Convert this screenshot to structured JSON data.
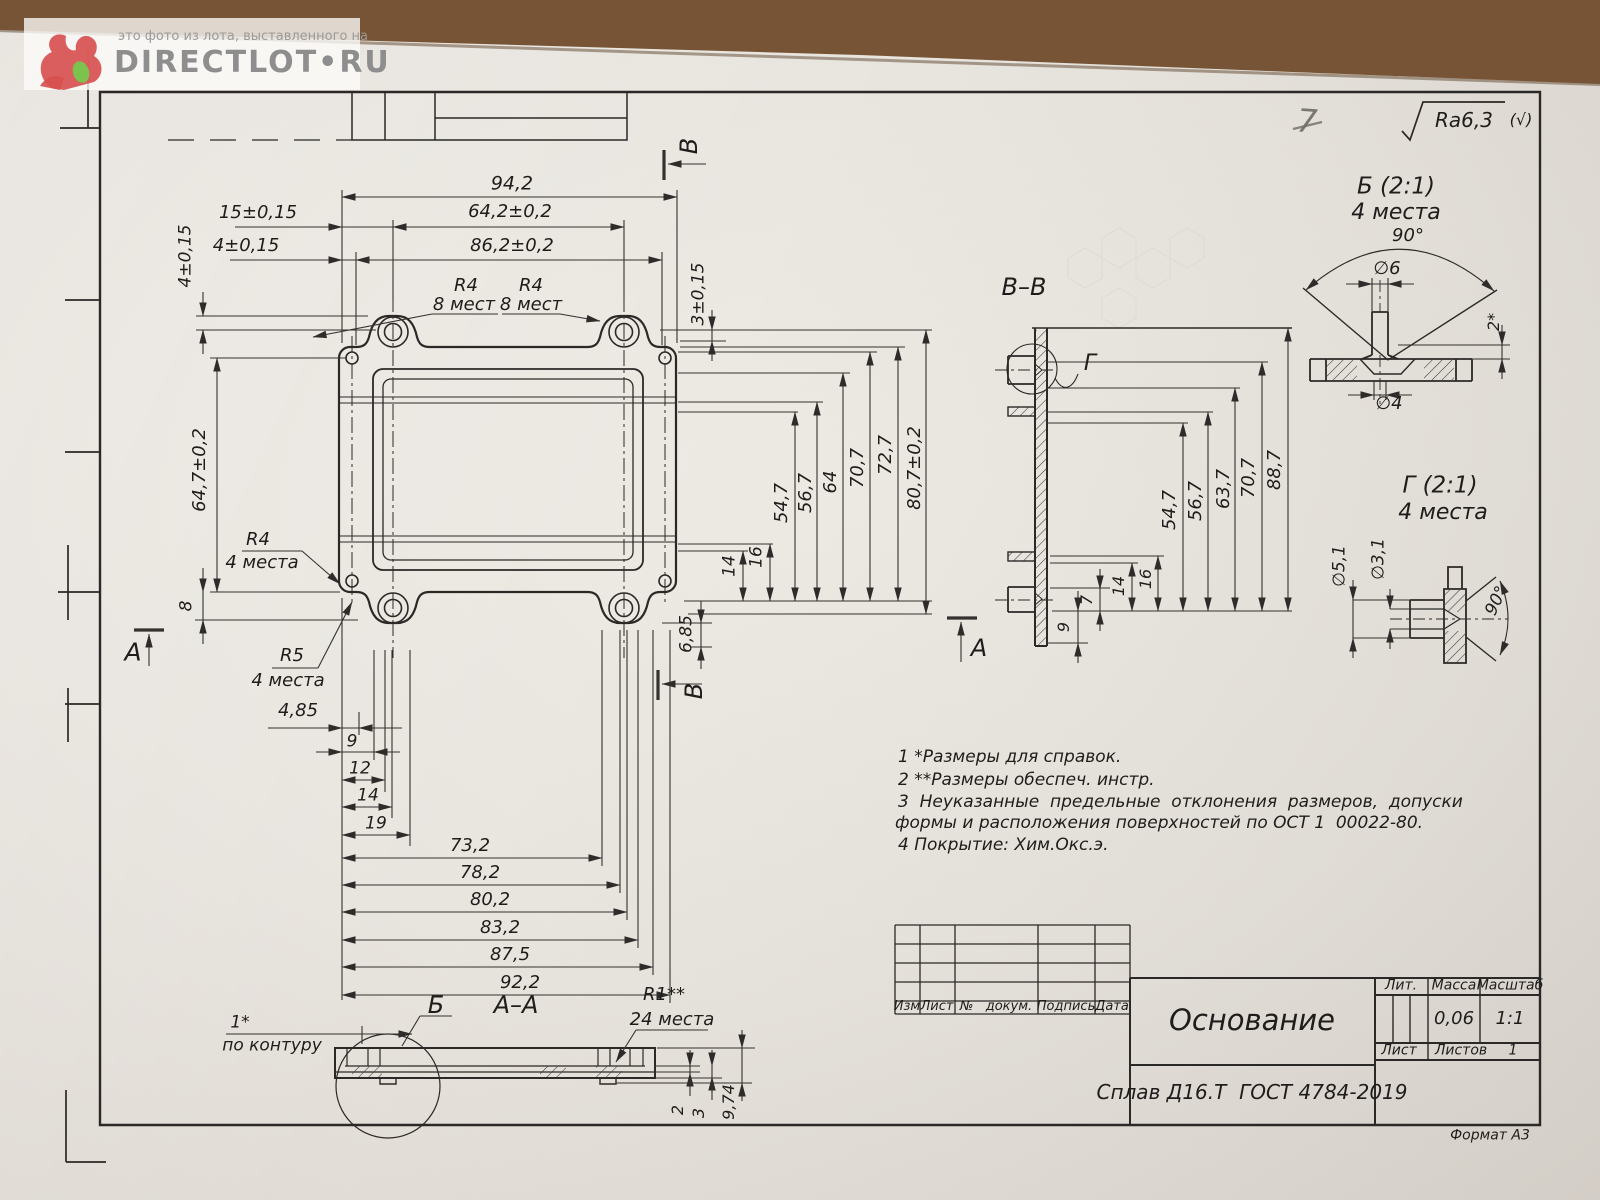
{
  "watermark": {
    "caption": "это фото из лота, выставленного на",
    "brand": "DIRECTLOT•RU"
  },
  "sheet": {
    "pencil_mark": "7",
    "surface_finish": "Ra6,3",
    "surface_finish_suffix": "(√)",
    "format_label": "Формат А3"
  },
  "colors": {
    "paper": "#e9e6e0",
    "line": "#2e2c2a",
    "wood": "#775435",
    "watermark_gray": "#8e8e8e",
    "logo_red": "#d85050",
    "logo_green": "#7cc24e",
    "pencil": "#6f6b66"
  },
  "notes": {
    "lines": [
      "1 *Размеры для справок.",
      "2 **Размеры обеспеч. инстр.",
      "3  Неуказанные  предельные  отклонения  размеров,  допуски",
      "формы и расположения поверхностей по ОСТ 1  00022-80.",
      "4 Покрытие: Хим.Окс.э."
    ]
  },
  "revision_table": {
    "headers": [
      "Изм",
      "Лист",
      "№   докум.",
      "Подпись",
      "Дата"
    ]
  },
  "title_block": {
    "part_name": "Основание",
    "lit_label": "Лит.",
    "mass_label": "Масса",
    "scale_label": "Масштаб",
    "mass_value": "0,06",
    "scale_value": "1:1",
    "sheet_label": "Лист",
    "sheets_label": "Листов",
    "sheets_value": "1",
    "material": "Сплав Д16.Т  ГОСТ 4784-2019"
  },
  "labels": [
    {
      "n": "dim-94-2",
      "t": "94,2",
      "x": 512,
      "y": 184,
      "s": 19
    },
    {
      "n": "dim-15",
      "t": "15±0,15",
      "x": 258,
      "y": 213,
      "s": 18
    },
    {
      "n": "dim-64-2",
      "t": "64,2±0,2",
      "x": 510,
      "y": 212,
      "s": 18
    },
    {
      "n": "dim-4-top",
      "t": "4±0,15",
      "x": 246,
      "y": 246,
      "s": 18
    },
    {
      "n": "dim-86-2",
      "t": "86,2±0,2",
      "x": 512,
      "y": 246,
      "s": 18
    },
    {
      "n": "radius-r4-top-1",
      "t": "R4",
      "x": 466,
      "y": 286,
      "s": 18
    },
    {
      "n": "radius-r4-top-1-qty",
      "t": "8 мест",
      "x": 464,
      "y": 305,
      "s": 18
    },
    {
      "n": "radius-r4-top-2",
      "t": "R4",
      "x": 531,
      "y": 286,
      "s": 18
    },
    {
      "n": "radius-r4-top-2-qty",
      "t": "8 мест",
      "x": 531,
      "y": 305,
      "s": 18
    },
    {
      "n": "dim-4-left",
      "t": "4±0,15",
      "x": 186,
      "y": 256,
      "s": 17,
      "r": -90
    },
    {
      "n": "dim-64-7",
      "t": "64,7±0,2",
      "x": 200,
      "y": 470,
      "s": 18,
      "r": -90
    },
    {
      "n": "radius-r4-left",
      "t": "R4",
      "x": 258,
      "y": 540,
      "s": 18
    },
    {
      "n": "radius-r4-left-qty",
      "t": "4 места",
      "x": 262,
      "y": 563,
      "s": 18
    },
    {
      "n": "dim-8",
      "t": "8",
      "x": 187,
      "y": 606,
      "s": 17,
      "r": -90
    },
    {
      "n": "section-mark-a-left",
      "t": "А",
      "x": 133,
      "y": 652,
      "s": 25
    },
    {
      "n": "radius-r5",
      "t": "R5",
      "x": 292,
      "y": 656,
      "s": 18
    },
    {
      "n": "radius-r5-qty",
      "t": "4 места",
      "x": 288,
      "y": 681,
      "s": 18
    },
    {
      "n": "dim-3-right",
      "t": "3±0,15",
      "x": 699,
      "y": 294,
      "s": 17,
      "r": -90
    },
    {
      "n": "dim-14-right",
      "t": "14",
      "x": 730,
      "y": 566,
      "s": 17,
      "r": -90
    },
    {
      "n": "dim-16-right",
      "t": "16",
      "x": 757,
      "y": 557,
      "s": 17,
      "r": -90
    },
    {
      "n": "dim-54-7",
      "t": "54,7",
      "x": 782,
      "y": 503,
      "s": 18,
      "r": -90
    },
    {
      "n": "dim-56-7",
      "t": "56,7",
      "x": 806,
      "y": 493,
      "s": 18,
      "r": -90
    },
    {
      "n": "dim-64",
      "t": "64",
      "x": 831,
      "y": 482,
      "s": 18,
      "r": -90
    },
    {
      "n": "dim-70-7",
      "t": "70,7",
      "x": 858,
      "y": 468,
      "s": 18,
      "r": -90
    },
    {
      "n": "dim-72-7",
      "t": "72,7",
      "x": 886,
      "y": 455,
      "s": 18,
      "r": -90
    },
    {
      "n": "dim-80-7",
      "t": "80,7±0,2",
      "x": 915,
      "y": 468,
      "s": 18,
      "r": -90
    },
    {
      "n": "dim-6-85",
      "t": "6,85",
      "x": 687,
      "y": 634,
      "s": 17,
      "r": -90
    },
    {
      "n": "section-mark-b-top",
      "t": "В",
      "x": 689,
      "y": 146,
      "s": 24,
      "r": -90
    },
    {
      "n": "section-mark-b-bottom",
      "t": "В",
      "x": 694,
      "y": 691,
      "s": 24,
      "r": -90
    },
    {
      "n": "dim-4-85",
      "t": "4,85",
      "x": 298,
      "y": 711,
      "s": 18
    },
    {
      "n": "dim-9",
      "t": "9",
      "x": 352,
      "y": 742,
      "s": 17
    },
    {
      "n": "dim-12",
      "t": "12",
      "x": 360,
      "y": 769,
      "s": 17
    },
    {
      "n": "dim-14-bottom",
      "t": "14",
      "x": 368,
      "y": 796,
      "s": 17
    },
    {
      "n": "dim-19",
      "t": "19",
      "x": 376,
      "y": 824,
      "s": 17
    },
    {
      "n": "dim-73-2",
      "t": "73,2",
      "x": 470,
      "y": 846,
      "s": 18
    },
    {
      "n": "dim-78-2",
      "t": "78,2",
      "x": 480,
      "y": 873,
      "s": 18
    },
    {
      "n": "dim-80-2",
      "t": "80,2",
      "x": 490,
      "y": 900,
      "s": 18
    },
    {
      "n": "dim-83-2",
      "t": "83,2",
      "x": 500,
      "y": 928,
      "s": 18
    },
    {
      "n": "dim-87-5",
      "t": "87,5",
      "x": 510,
      "y": 955,
      "s": 18
    },
    {
      "n": "dim-92-2",
      "t": "92,2",
      "x": 520,
      "y": 983,
      "s": 18
    },
    {
      "n": "ref-1-star",
      "t": "1*",
      "x": 240,
      "y": 1023,
      "s": 17
    },
    {
      "n": "ref-contour",
      "t": "по контуру",
      "x": 272,
      "y": 1046,
      "s": 17
    },
    {
      "n": "callout-b",
      "t": "Б",
      "x": 436,
      "y": 1005,
      "s": 24
    },
    {
      "n": "section-title-a-a",
      "t": "А–А",
      "x": 516,
      "y": 1005,
      "s": 24
    },
    {
      "n": "radius-r1",
      "t": "R1**",
      "x": 664,
      "y": 995,
      "s": 18
    },
    {
      "n": "radius-r1-qty",
      "t": "24 места",
      "x": 672,
      "y": 1020,
      "s": 18
    },
    {
      "n": "dim-2-aa",
      "t": "2",
      "x": 678,
      "y": 1110,
      "s": 16,
      "r": -90
    },
    {
      "n": "dim-3-aa",
      "t": "3",
      "x": 699,
      "y": 1113,
      "s": 16,
      "r": -90
    },
    {
      "n": "dim-9-74",
      "t": "9,74",
      "x": 729,
      "y": 1102,
      "s": 16,
      "r": -90
    },
    {
      "n": "section-title-v-v",
      "t": "В–В",
      "x": 1024,
      "y": 287,
      "s": 24
    },
    {
      "n": "callout-g",
      "t": "Г",
      "x": 1090,
      "y": 364,
      "s": 22
    },
    {
      "n": "dim-54-7-vv",
      "t": "54,7",
      "x": 1170,
      "y": 510,
      "s": 18,
      "r": -90
    },
    {
      "n": "dim-56-7-vv",
      "t": "56,7",
      "x": 1196,
      "y": 501,
      "s": 18,
      "r": -90
    },
    {
      "n": "dim-63-7-vv",
      "t": "63,7",
      "x": 1224,
      "y": 489,
      "s": 18,
      "r": -90
    },
    {
      "n": "dim-70-7-vv",
      "t": "70,7",
      "x": 1249,
      "y": 478,
      "s": 18,
      "r": -90
    },
    {
      "n": "dim-88-7-vv",
      "t": "88,7",
      "x": 1275,
      "y": 470,
      "s": 18,
      "r": -90
    },
    {
      "n": "dim-7-vv",
      "t": "7",
      "x": 1087,
      "y": 600,
      "s": 16,
      "r": -90
    },
    {
      "n": "dim-14-vv",
      "t": "14",
      "x": 1119,
      "y": 586,
      "s": 16,
      "r": -90
    },
    {
      "n": "dim-16-vv",
      "t": "16",
      "x": 1146,
      "y": 579,
      "s": 16,
      "r": -90
    },
    {
      "n": "dim-9-vv",
      "t": "9",
      "x": 1064,
      "y": 627,
      "s": 16,
      "r": -90
    },
    {
      "n": "section-mark-a-vv",
      "t": "А",
      "x": 979,
      "y": 648,
      "s": 24
    },
    {
      "n": "pencil-mark",
      "t": "7",
      "x": 1307,
      "y": 121,
      "s": 32,
      "c": "pencil",
      "r": 4
    },
    {
      "n": "roughness-value",
      "t": "Ra6,3",
      "x": 1464,
      "y": 120,
      "s": 20
    },
    {
      "n": "roughness-suffix",
      "t": "(√)",
      "x": 1521,
      "y": 120,
      "s": 16
    },
    {
      "n": "detail-b-title",
      "t": "Б (2:1)",
      "x": 1396,
      "y": 187,
      "s": 23
    },
    {
      "n": "detail-b-qty",
      "t": "4 места",
      "x": 1396,
      "y": 213,
      "s": 22
    },
    {
      "n": "detail-b-angle",
      "t": "90°",
      "x": 1408,
      "y": 236,
      "s": 18
    },
    {
      "n": "detail-b-dia6",
      "t": "∅6",
      "x": 1387,
      "y": 269,
      "s": 18
    },
    {
      "n": "detail-b-dia4",
      "t": "∅4",
      "x": 1389,
      "y": 404,
      "s": 18
    },
    {
      "n": "detail-b-2star",
      "t": "2*",
      "x": 1494,
      "y": 322,
      "s": 16,
      "r": -90
    },
    {
      "n": "detail-g-title",
      "t": "Г (2:1)",
      "x": 1440,
      "y": 486,
      "s": 23
    },
    {
      "n": "detail-g-qty",
      "t": "4 места",
      "x": 1443,
      "y": 513,
      "s": 22
    },
    {
      "n": "detail-g-dia51",
      "t": "∅5,1",
      "x": 1340,
      "y": 566,
      "s": 17,
      "r": -90
    },
    {
      "n": "detail-g-dia31",
      "t": "∅3,1",
      "x": 1379,
      "y": 559,
      "s": 17,
      "r": -90
    },
    {
      "n": "detail-g-angle",
      "t": "90°",
      "x": 1497,
      "y": 601,
      "s": 17,
      "r": -65
    }
  ]
}
